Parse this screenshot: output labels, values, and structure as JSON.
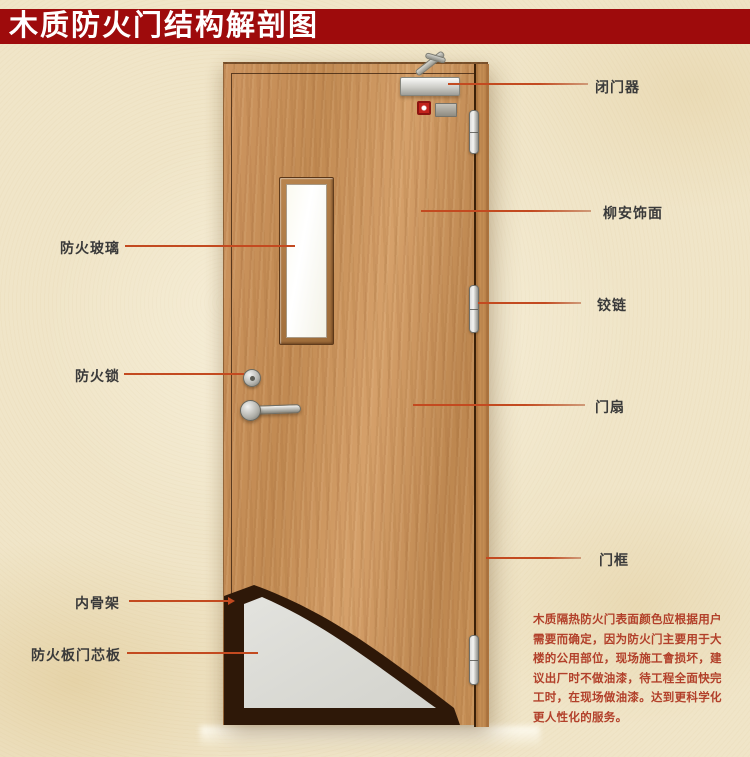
{
  "title": "木质防火门结构解剖图",
  "annotations": {
    "left": [
      {
        "text": "防火玻璃"
      },
      {
        "text": "防火锁"
      },
      {
        "text": "内骨架"
      },
      {
        "text": "防火板门芯板"
      }
    ],
    "right": [
      {
        "text": "闭门器"
      },
      {
        "text": "柳安饰面"
      },
      {
        "text": "铰链"
      },
      {
        "text": "门扇"
      },
      {
        "text": "门框"
      }
    ]
  },
  "note": "木质隔热防火门表面颜色应根据用户\n需要而确定，因为防火门主要用于大\n楼的公用部位，现场施工會损坏，建\n议出厂时不做油漆，待工程全面快完\n工时，在现场做油漆。达到更科学化\n更人性化的服务。",
  "colors": {
    "title_bg": "#9e0b0c",
    "leader_line": "#c34a20",
    "note_text": "#b2402a",
    "inner_skeleton": "#2e1808",
    "core_board": "#dadad4",
    "background": "#f0e5c8"
  }
}
